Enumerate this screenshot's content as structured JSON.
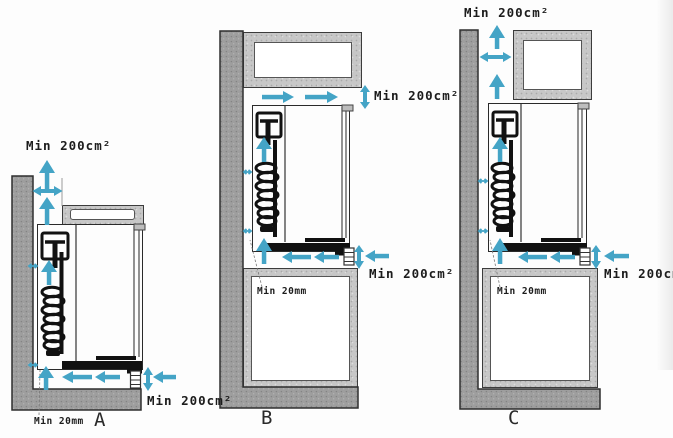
{
  "colors": {
    "arrow": "#44a4c6",
    "wall": "#9e9e9e",
    "cabinet": "#c7c7c7",
    "ink": "#1c1c1c"
  },
  "diagrams": {
    "a": {
      "name": "A",
      "vent_top_label": "Min 200cm²",
      "vent_bottom_label": "Min 200cm²",
      "clearance_label": "Min 20mm"
    },
    "b": {
      "name": "B",
      "vent_top_label": "Min 200cm²",
      "vent_bottom_label": "Min 200cm²",
      "clearance_label": "Min 20mm"
    },
    "c": {
      "name": "C",
      "vent_top_label": "Min 200cm²",
      "vent_bottom_label": "Min 200cm²",
      "clearance_label": "Min 20mm"
    }
  }
}
